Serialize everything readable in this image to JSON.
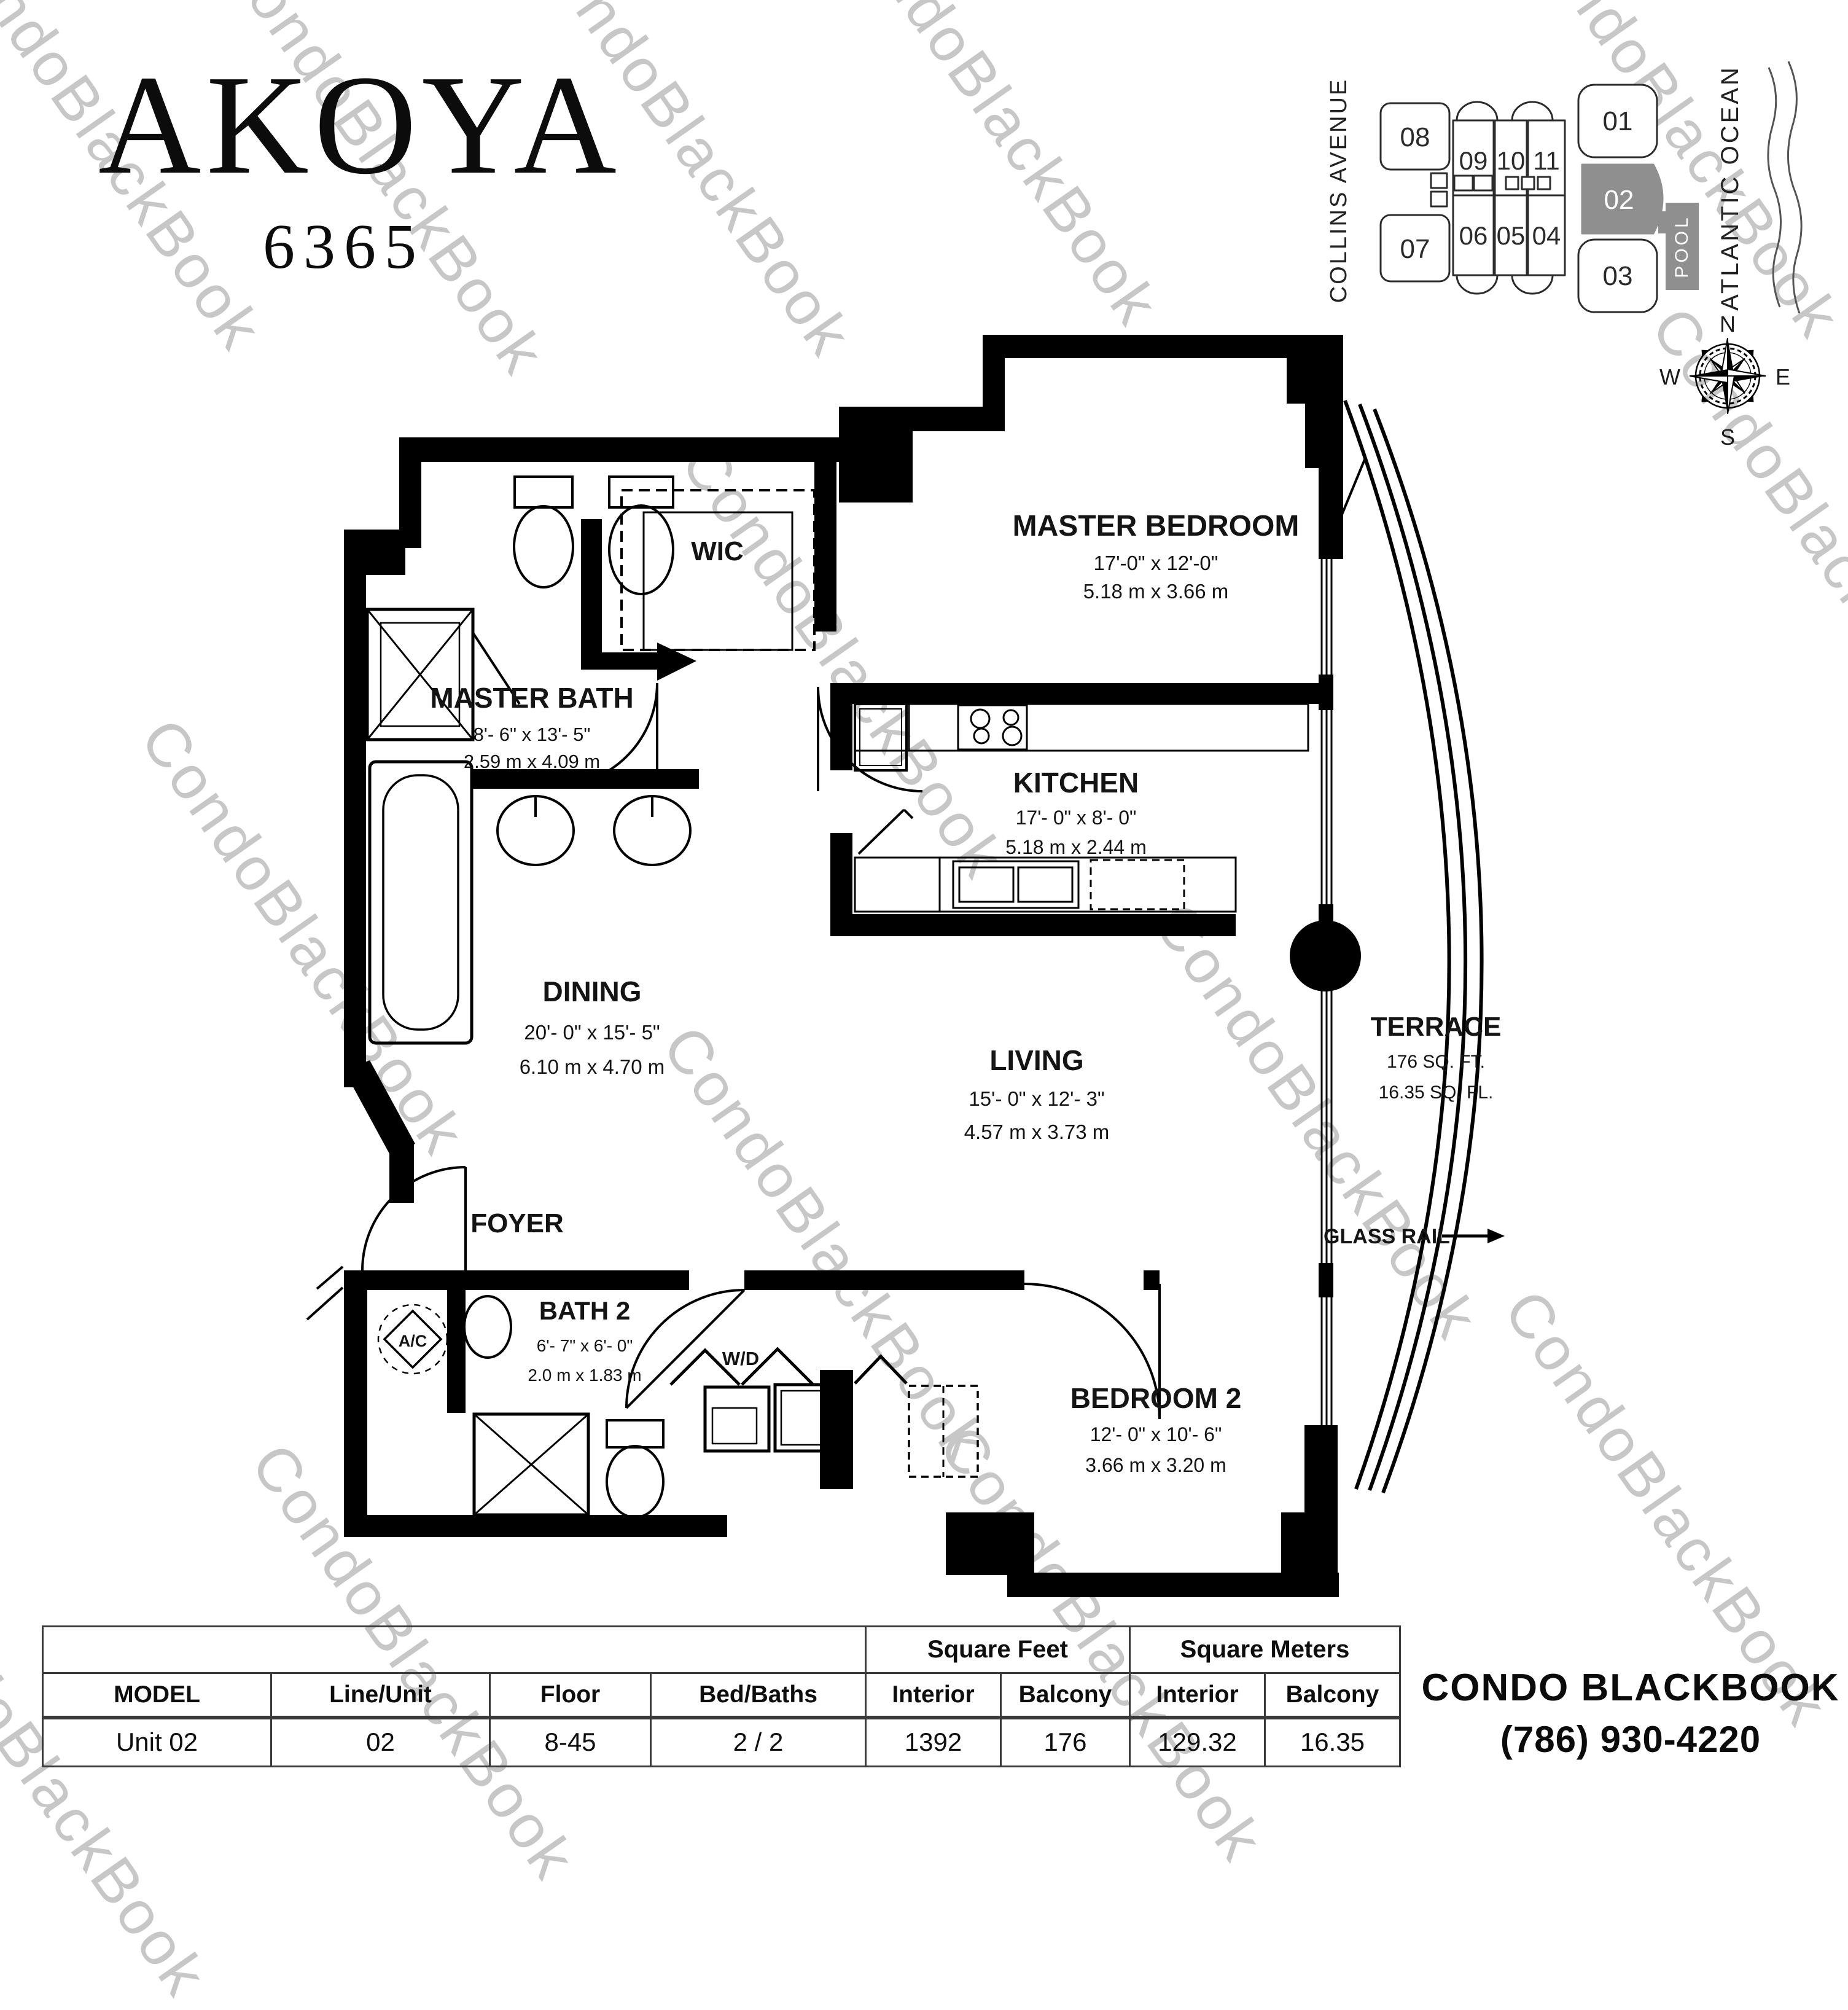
{
  "title": {
    "name": "AKOYA",
    "number": "6365"
  },
  "watermark": {
    "text": "CondoBlackBook"
  },
  "keyplan": {
    "street": "COLLINS AVENUE",
    "ocean": "ATLANTIC OCEAN",
    "pool": "POOL",
    "highlighted_unit": "02",
    "units": {
      "u01": "01",
      "u02": "02",
      "u03": "03",
      "u04": "04",
      "u05": "05",
      "u06": "06",
      "u07": "07",
      "u08": "08",
      "u09": "09",
      "u10": "10",
      "u11": "11"
    },
    "compass": {
      "n": "N",
      "e": "E",
      "s": "S",
      "w": "W"
    }
  },
  "rooms": {
    "master_bedroom": {
      "name": "MASTER BEDROOM",
      "dims_ft": "17'-0\" x 12'-0\"",
      "dims_m": "5.18 m x 3.66 m"
    },
    "wic": {
      "name": "WIC"
    },
    "master_bath": {
      "name": "MASTER BATH",
      "dims_ft": "8'- 6\" x 13'- 5\"",
      "dims_m": "2.59 m x 4.09 m"
    },
    "kitchen": {
      "name": "KITCHEN",
      "dims_ft": "17'- 0\" x 8'- 0\"",
      "dims_m": "5.18 m x 2.44 m"
    },
    "dining": {
      "name": "DINING",
      "dims_ft": "20'- 0\" x 15'- 5\"",
      "dims_m": "6.10 m x 4.70 m"
    },
    "living": {
      "name": "LIVING",
      "dims_ft": "15'- 0\" x 12'- 3\"",
      "dims_m": "4.57 m x 3.73 m"
    },
    "terrace": {
      "name": "TERRACE",
      "area_ft": "176 SQ. FT.",
      "area_m": "16.35 SQ. FL."
    },
    "glass_rail": {
      "label": "GLASS RAIL"
    },
    "foyer": {
      "name": "FOYER"
    },
    "bath2": {
      "name": "BATH 2",
      "dims_ft": "6'- 7\" x 6'- 0\"",
      "dims_m": "2.0 m x 1.83 m"
    },
    "wd": {
      "label": "W/D"
    },
    "ac": {
      "label": "A/C"
    },
    "bedroom2": {
      "name": "BEDROOM 2",
      "dims_ft": "12'- 0\" x 10'- 6\"",
      "dims_m": "3.66 m x 3.20 m"
    }
  },
  "table": {
    "group_headers": {
      "square_feet": "Square Feet",
      "square_meters": "Square Meters"
    },
    "headers": {
      "model": "MODEL",
      "line_unit": "Line/Unit",
      "floor": "Floor",
      "bed_baths": "Bed/Baths",
      "interior_sf": "Interior",
      "balcony_sf": "Balcony",
      "interior_sm": "Interior",
      "balcony_sm": "Balcony"
    },
    "row": {
      "model": "Unit 02",
      "line_unit": "02",
      "floor": "8-45",
      "bed_baths": "2 / 2",
      "interior_sf": "1392",
      "balcony_sf": "176",
      "interior_sm": "129.32",
      "balcony_sm": "16.35"
    }
  },
  "footer": {
    "brand": "CONDO BLACKBOOK",
    "phone": "(786) 930-4220"
  },
  "colors": {
    "wall": "#000000",
    "highlight_gray": "#8f8f8f",
    "watermark": "#c7c7c7"
  }
}
